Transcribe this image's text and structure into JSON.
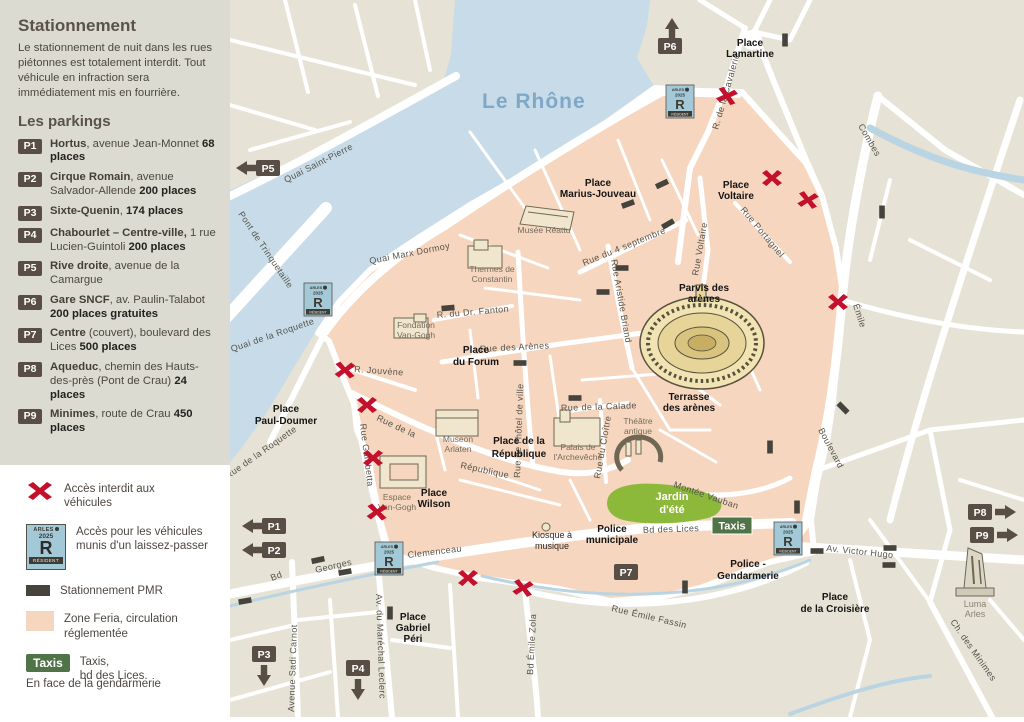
{
  "sidebar": {
    "title": "Stationnement",
    "intro": "Le stationnement de nuit dans les rues piétonnes est totalement interdit. Tout véhicule en infraction sera immédiatement mis en fourrière.",
    "parkings_title": "Les parkings",
    "parkings": [
      {
        "id": "P1",
        "name": "Hortus",
        "mid": ", avenue Jean-Monnet ",
        "places": "68 places"
      },
      {
        "id": "P2",
        "name": "Cirque Romain",
        "mid": ", avenue Salvador-Allende ",
        "places": "200 places"
      },
      {
        "id": "P3",
        "name": "Sixte-Quenin",
        "mid": ", ",
        "places": "174 places"
      },
      {
        "id": "P4",
        "name": "Chabourlet – Centre-ville,",
        "mid": " 1 rue Lucien-Guintoli ",
        "places": "200 places"
      },
      {
        "id": "P5",
        "name": "Rive droite",
        "mid": ", avenue de la Camargue",
        "places": ""
      },
      {
        "id": "P6",
        "name": "Gare SNCF",
        "mid": ", av. Paulin-Talabot ",
        "places": "200 places gratuites"
      },
      {
        "id": "P7",
        "name": "Centre",
        "mid": " (couvert), boulevard des Lices ",
        "places": "500 places"
      },
      {
        "id": "P8",
        "name": "Aqueduc",
        "mid": ", chemin des Hauts-des-près (Pont de Crau) ",
        "places": "24 places"
      },
      {
        "id": "P9",
        "name": "Minimes",
        "mid": ", route de Crau ",
        "places": "450 places"
      }
    ]
  },
  "legend": {
    "no_access": "Accès interdit aux véhicules",
    "resident_access": "Accès pour les véhicules munis d'un laissez-passer",
    "pmr": "Stationnement PMR",
    "feria": "Zone Feria, circulation réglementée",
    "taxis_lines": [
      "Taxis,",
      "bd des Lices.",
      "En face de la gendarmerie"
    ]
  },
  "badges": {
    "arles": "ARLES",
    "year": "2025",
    "r": "R",
    "resident": "RÉSIDENT",
    "taxis": "Taxis"
  },
  "map": {
    "river": "Le Rhône",
    "places": {
      "lamartine": [
        "Place",
        "Lamartine"
      ],
      "voltaire": [
        "Place",
        "Voltaire"
      ],
      "marius": [
        "Place",
        "Marius-Jouveau"
      ],
      "parvis": [
        "Parvis des",
        "arènes"
      ],
      "terrasse": [
        "Terrasse",
        "des arènes"
      ],
      "forum": [
        "Place",
        "du Forum"
      ],
      "republique": [
        "Place de la",
        "République"
      ],
      "paul_doumer": [
        "Place",
        "Paul-Doumer"
      ],
      "wilson": [
        "Place",
        "Wilson"
      ],
      "jardin": [
        "Jardin",
        "d'été"
      ],
      "police_municipale": [
        "Police",
        "municipale"
      ],
      "gendarmerie": [
        "Police -",
        "Gendarmerie"
      ],
      "gabriel_peri": [
        "Place",
        "Gabriel",
        "Péri"
      ],
      "croisiere": [
        "Place",
        "de la Croisière"
      ],
      "kiosque": [
        "Kiosque à",
        "musique"
      ],
      "luma": [
        "Luma",
        "Arles"
      ]
    },
    "landmarks": {
      "reattu": "Musée Réattu",
      "thermes": [
        "Thermes de",
        "Constantin"
      ],
      "fondation": [
        "Fondation",
        "Van-Gogh"
      ],
      "museon": [
        "Museon",
        "Arlaten"
      ],
      "espace": [
        "Espace",
        "Van-Gogh"
      ],
      "palais": [
        "Palais de",
        "l'Archevêché"
      ],
      "theatre": [
        "Théâtre",
        "antique"
      ]
    },
    "streets": {
      "quai_st_pierre": "Quai  Saint-Pierre",
      "pont": "Pont de Trinquetaille",
      "marx_dormoy": "Quai  Marx  Dormoy",
      "quai_roquette": "Quai de la Roquette",
      "rue_roquette": "Rue de la Roquette",
      "cavalerie": "R. de la Cavalerie",
      "septembre": "Rue  du  4  septembre",
      "voltaire": "Rue  Voltaire",
      "portagnel": "Rue  Portagnel",
      "combes": "Combes",
      "emile": "Émile",
      "boulevard": "Boulevard",
      "briand": "Rue  Aristide  Briand",
      "hotel_ville": "Rue de l'hôtel de ville",
      "fanton": "R. du Dr. Fanton",
      "arenes": "Rue  des  Arènes",
      "jouvene": "R. Jouvène",
      "republique_a": "Rue  de  la",
      "republique_b": "République",
      "gambetta": "Rue  Gambetta",
      "calade": "Rue de la Calade",
      "cloitre": "Rue  du  Cloître",
      "vauban": "Montée Vauban",
      "lices": "Bd  des  Lices",
      "victor_hugo": "Av. Victor Hugo",
      "fassin": "Rue  Émile  Fassin",
      "clemenceau": "Clemenceau",
      "bd": "Bd",
      "georges": "Georges",
      "carnot": "Avenue  Sadi  Carnot",
      "leclerc": "Av. du  Maréchal  Leclerc",
      "zola": "Bd  Émile  Zola",
      "minimes": "Ch.  des  Minimes"
    },
    "markers": {
      "p1": "P1",
      "p2": "P2",
      "p3": "P3",
      "p4": "P4",
      "p5": "P5",
      "p6": "P6",
      "p7": "P7",
      "p8": "P8",
      "p9": "P9"
    }
  }
}
